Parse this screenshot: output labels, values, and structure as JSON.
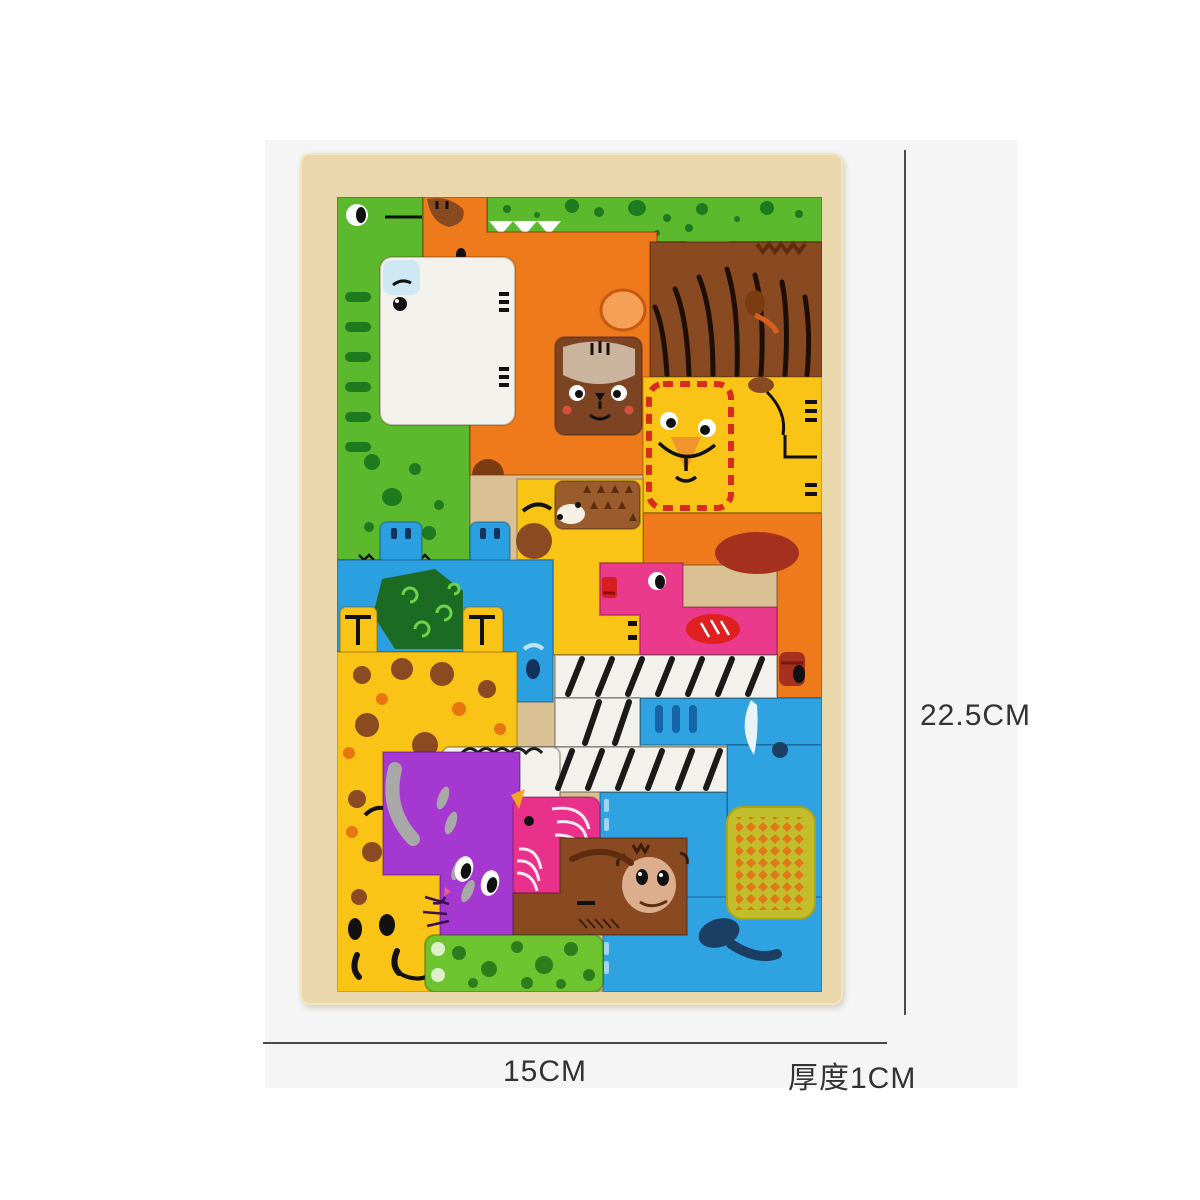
{
  "photo": {
    "background": "#f5f5f6",
    "page_background": "#ffffff",
    "subject": "wooden animal tetris block puzzle board"
  },
  "board": {
    "frame_color": "#ead7ab",
    "inner_color": "#d9c193"
  },
  "pieces": {
    "crocodile": {
      "color": "#5cb92e",
      "spot_color": "#1e7a1f",
      "toe_color": "#9ee06a"
    },
    "horse": {
      "color": "#ef7a1b",
      "mane_color": "#8a4a21"
    },
    "polar_bear": {
      "color": "#f2f1ec",
      "ear_color": "#cfe8f4"
    },
    "tiger": {
      "color": "#8a4a21",
      "stripe_color": "#1d0f04",
      "face_color": "#7c4423",
      "patch_color": "#cbb49e"
    },
    "lion": {
      "color": "#f9c415",
      "mane_color": "#d92b1e",
      "muzzle_color": "#f0952b",
      "tail_color": "#8a4a21"
    },
    "hedgehog": {
      "color": "#9a5b2d",
      "spike_color": "#5e2d0e"
    },
    "elephant_orange": {
      "color": "#ef7a1b",
      "ear_color": "#a5301e"
    },
    "giraffe_neck": {
      "color": "#f9c415",
      "muzzle_color": "#8a4a22"
    },
    "flamingo": {
      "color": "#ea3a8c",
      "wing_color": "#e02020",
      "beak_color": "#d81f1f"
    },
    "turtle": {
      "color": "#2ba0e0",
      "shell_color": "#1c6b22",
      "swirl_color": "#6fd34a"
    },
    "giraffe": {
      "color": "#f9c415",
      "spot_brown": "#8a4a22",
      "spot_orange": "#e8760f"
    },
    "zebra_goat": {
      "color": "#f2f1ec",
      "stripe_color": "#1a1a1a",
      "muzzle_color": "#f2a3b3"
    },
    "elephant_blue": {
      "color": "#2fa3e2",
      "bar_color": "#1565a8",
      "tail_color": "#1a3f63",
      "light_color": "#9fd4f2",
      "tusk_color": "#e8f4fa"
    },
    "mat": {
      "color": "#c2bd2a",
      "diamond_color": "#e07818"
    },
    "cat": {
      "color": "#a438d0",
      "tail_color": "#a8a8a8"
    },
    "bird": {
      "color": "#e9308b",
      "beak_color": "#f5a623"
    },
    "monkey": {
      "color": "#8a4a21",
      "face_color": "#dcae8e",
      "arm_color": "#5e2d0e"
    },
    "frog": {
      "color": "#6ec42e",
      "spot_color": "#2e7d1d",
      "eye_color": "#dff0c8"
    }
  },
  "dimensions": {
    "height_label": "22.5CM",
    "width_label": "15CM",
    "thickness_label": "厚度1CM",
    "line_color": "#4a4a4a",
    "text_color": "#333333"
  }
}
